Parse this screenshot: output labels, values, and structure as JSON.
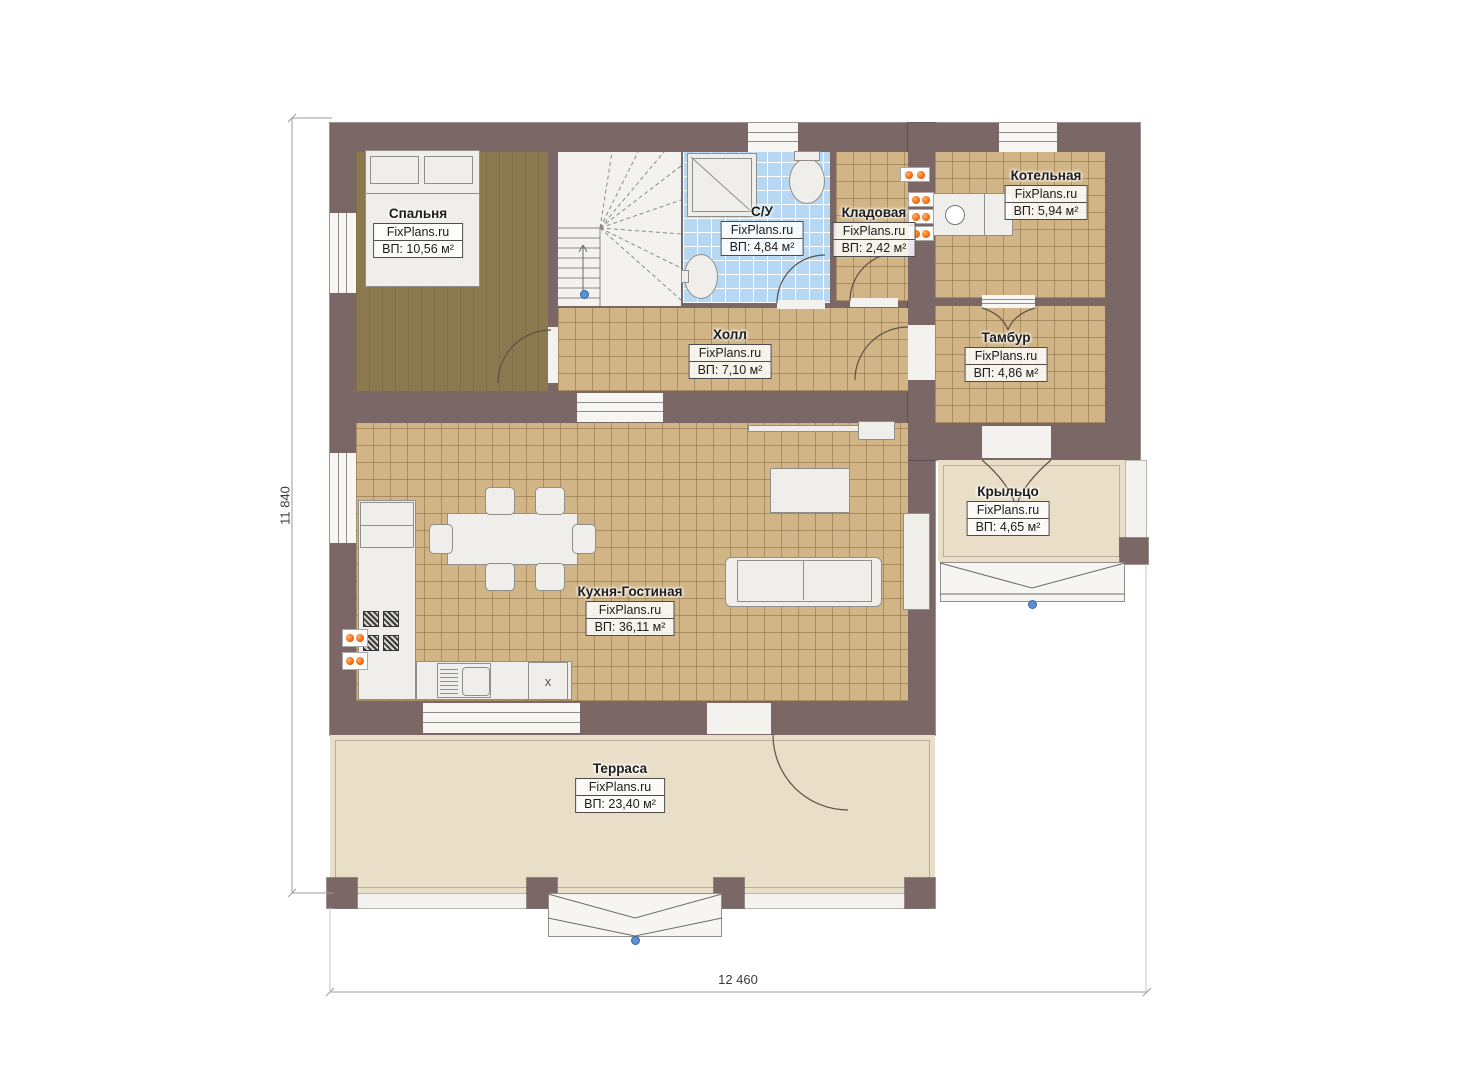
{
  "plan": {
    "brand": "FixPlans.ru",
    "rooms": [
      {
        "id": "bedroom",
        "name": "Спальня",
        "site": "FixPlans.ru",
        "area": "ВП: 10,56 м²"
      },
      {
        "id": "bathroom",
        "name": "С/У",
        "site": "FixPlans.ru",
        "area": "ВП: 4,84 м²"
      },
      {
        "id": "storage",
        "name": "Кладовая",
        "site": "FixPlans.ru",
        "area": "ВП: 2,42 м²"
      },
      {
        "id": "boiler",
        "name": "Котельная",
        "site": "FixPlans.ru",
        "area": "ВП: 5,94 м²"
      },
      {
        "id": "hall",
        "name": "Холл",
        "site": "FixPlans.ru",
        "area": "ВП: 7,10 м²"
      },
      {
        "id": "vestibule",
        "name": "Тамбур",
        "site": "FixPlans.ru",
        "area": "ВП: 4,86 м²"
      },
      {
        "id": "porch",
        "name": "Крыльцо",
        "site": "FixPlans.ru",
        "area": "ВП: 4,65 м²"
      },
      {
        "id": "kitchen",
        "name": "Кухня-Гостиная",
        "site": "FixPlans.ru",
        "area": "ВП: 36,11 м²"
      },
      {
        "id": "terrace",
        "name": "Терраса",
        "site": "FixPlans.ru",
        "area": "ВП: 23,40 м²"
      }
    ],
    "dimensions": {
      "height_label": "11 840",
      "width_label": "12 460"
    },
    "appliance_label": "х",
    "colors": {
      "wall": "#7c6767",
      "tile": "#d1b586",
      "wood": "#8b7950",
      "bath_tile": "#b7d8f2",
      "outdoor": "#e9dec7",
      "radiator": "#f26a12",
      "marker": "#5b8fd6"
    }
  }
}
